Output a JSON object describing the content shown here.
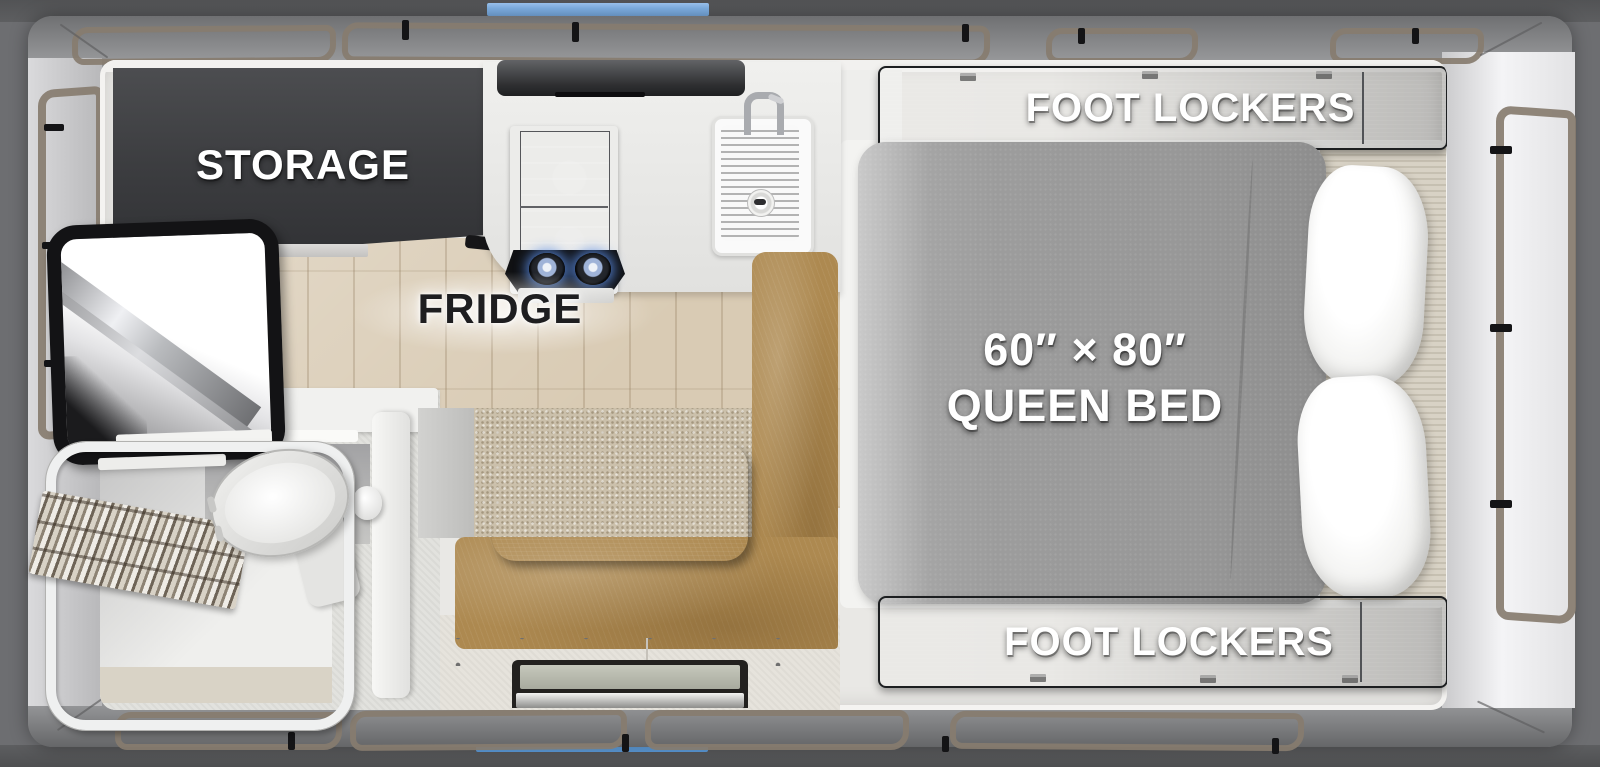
{
  "floorplan": {
    "labels": {
      "storage": "STORAGE",
      "fridge": "FRIDGE",
      "foot_lockers_top": "FOOT LOCKERS",
      "foot_lockers_bottom": "FOOT LOCKERS",
      "bed_size": "60″ × 80″",
      "bed_name": "QUEEN BED"
    },
    "colors": {
      "accent_blue_top": "#83b5e9",
      "accent_blue_bottom": "#66a5e2",
      "cabinet_wood_dark": "#35373a",
      "mattress_gray": "#9d9d9d",
      "bench_leather_tan": "#ad8950",
      "table_wood": "#44464a",
      "carpet_beige": "#cbc0ab",
      "floor_wood": "#d9cbb4",
      "awning_trim_taupe": "#877c6f",
      "wall_gray": "#8e8f91",
      "background_gray": "#6d6e71"
    }
  }
}
